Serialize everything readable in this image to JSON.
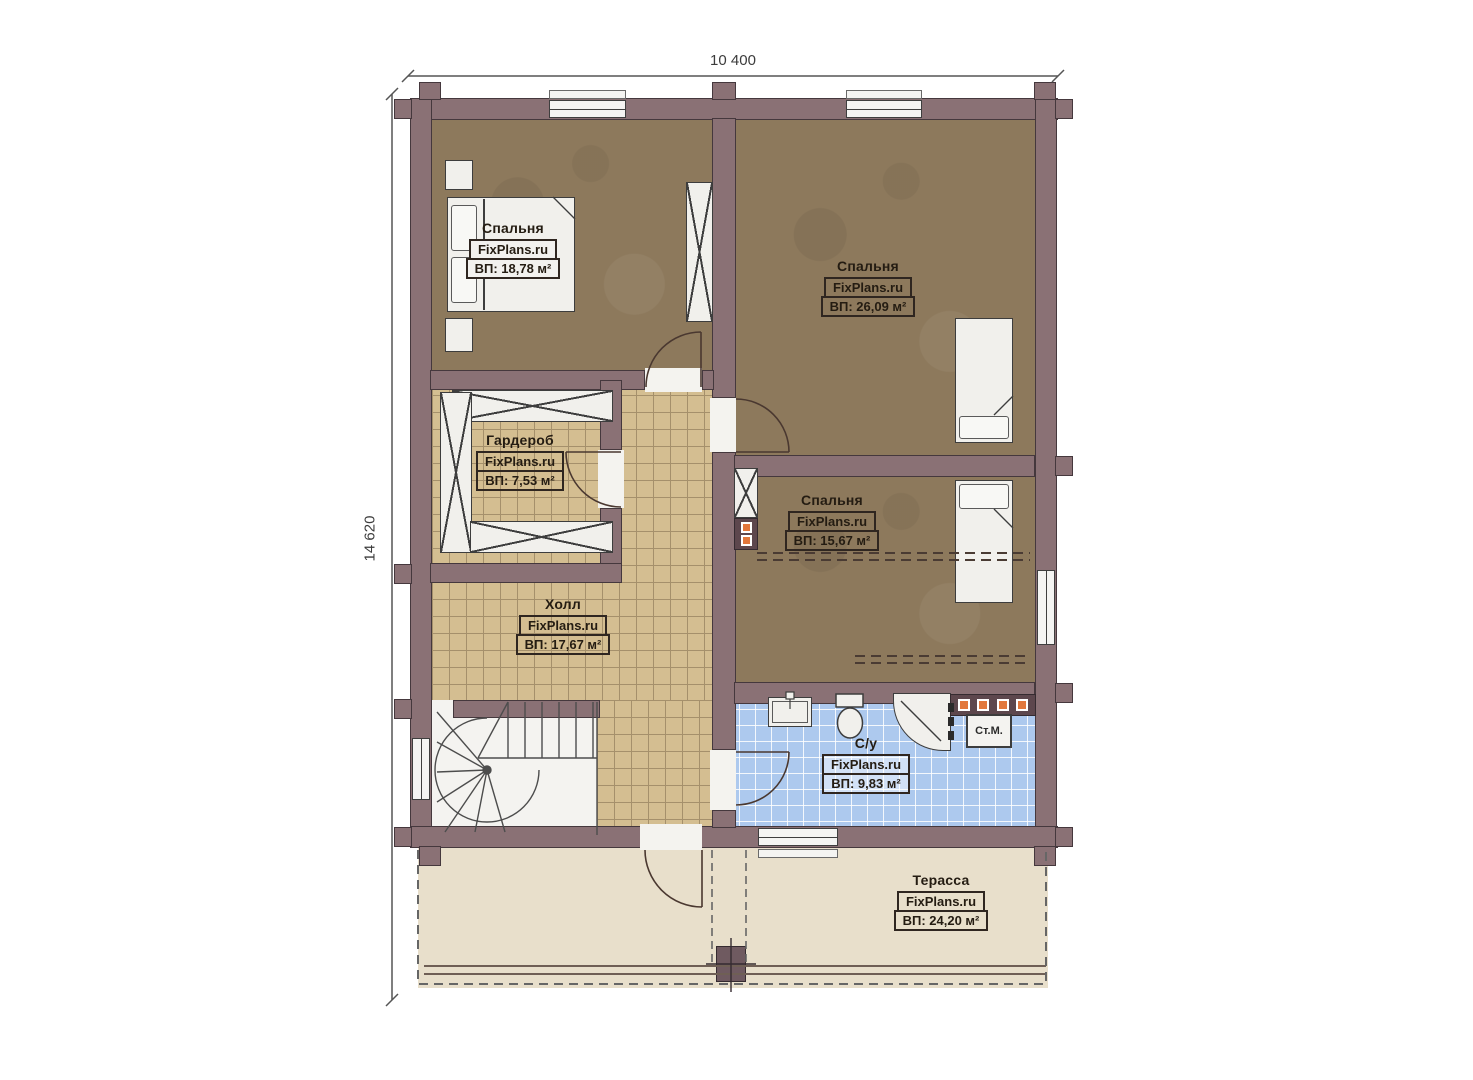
{
  "plan": {
    "dimensions": {
      "top": "10 400",
      "left": "14 620"
    },
    "watermark": "FixPlans.ru",
    "rooms": [
      {
        "key": "bedroom-1",
        "name": "Спальня",
        "area": "ВП: 18,78 м²"
      },
      {
        "key": "bedroom-2",
        "name": "Спальня",
        "area": "ВП: 26,09 м²"
      },
      {
        "key": "wardrobe",
        "name": "Гардероб",
        "area": "ВП: 7,53 м²"
      },
      {
        "key": "bedroom-3",
        "name": "Спальня",
        "area": "ВП: 15,67 м²"
      },
      {
        "key": "hall",
        "name": "Холл",
        "area": "ВП: 17,67 м²"
      },
      {
        "key": "bathroom",
        "name": "С/у",
        "area": "ВП: 9,83 м²"
      },
      {
        "key": "terrace",
        "name": "Терасса",
        "area": "ВП: 24,20 м²"
      }
    ],
    "appliances": {
      "washing_machine": "Ст.М."
    },
    "colors": {
      "wall": "#8a7175",
      "wood_floor": "#8d795c",
      "tile_floor": "#d4be91",
      "bath_tile": "#adc9ee",
      "terrace_floor": "#e8dfcb",
      "accent_orange": "#e2773b"
    }
  }
}
